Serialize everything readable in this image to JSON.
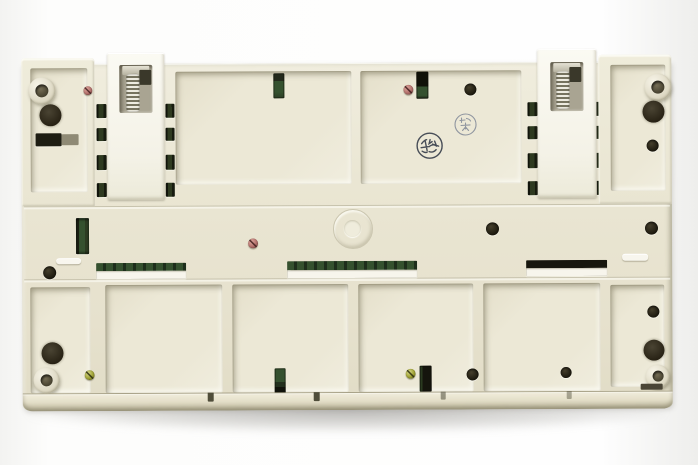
{
  "scene": {
    "type": "photograph",
    "subject": "Underside of a beige plastic electronic module (PLC base unit) with two DIN-rail spring clips, corner keyhole mounts, recessed compartments, green PCB visible through vent slots and windows, retaining screws, and two circular ink inspection stamps",
    "background": "#fdfdfc"
  },
  "colors": {
    "body": "#eae6d3",
    "body_light": "#f0edde",
    "recess": "#ece8d6",
    "slot_dark": "#1e1d13",
    "pcb_green": "#35512f",
    "pcb_green_dark": "#2e3a20",
    "metal_spring": "#cfccbd",
    "screw_pink": "#b5736e",
    "screw_yellow": "#a2a437",
    "hole_dark": "#1b180d",
    "stamp_ink_dark": "#474d57",
    "stamp_ink_faint": "#9096a0"
  },
  "markings": {
    "stamp_dark": "circular ink inspection stamp with Asian characters (dark)",
    "stamp_faint": "circular ink inspection stamp with Asian characters (faint)"
  },
  "hardware": {
    "din_clips": 2,
    "keyhole_mounts": 4,
    "screws_pink": 3,
    "screws_yellow": 2,
    "pcb_windows": 3,
    "green_vent_slots": 6
  }
}
